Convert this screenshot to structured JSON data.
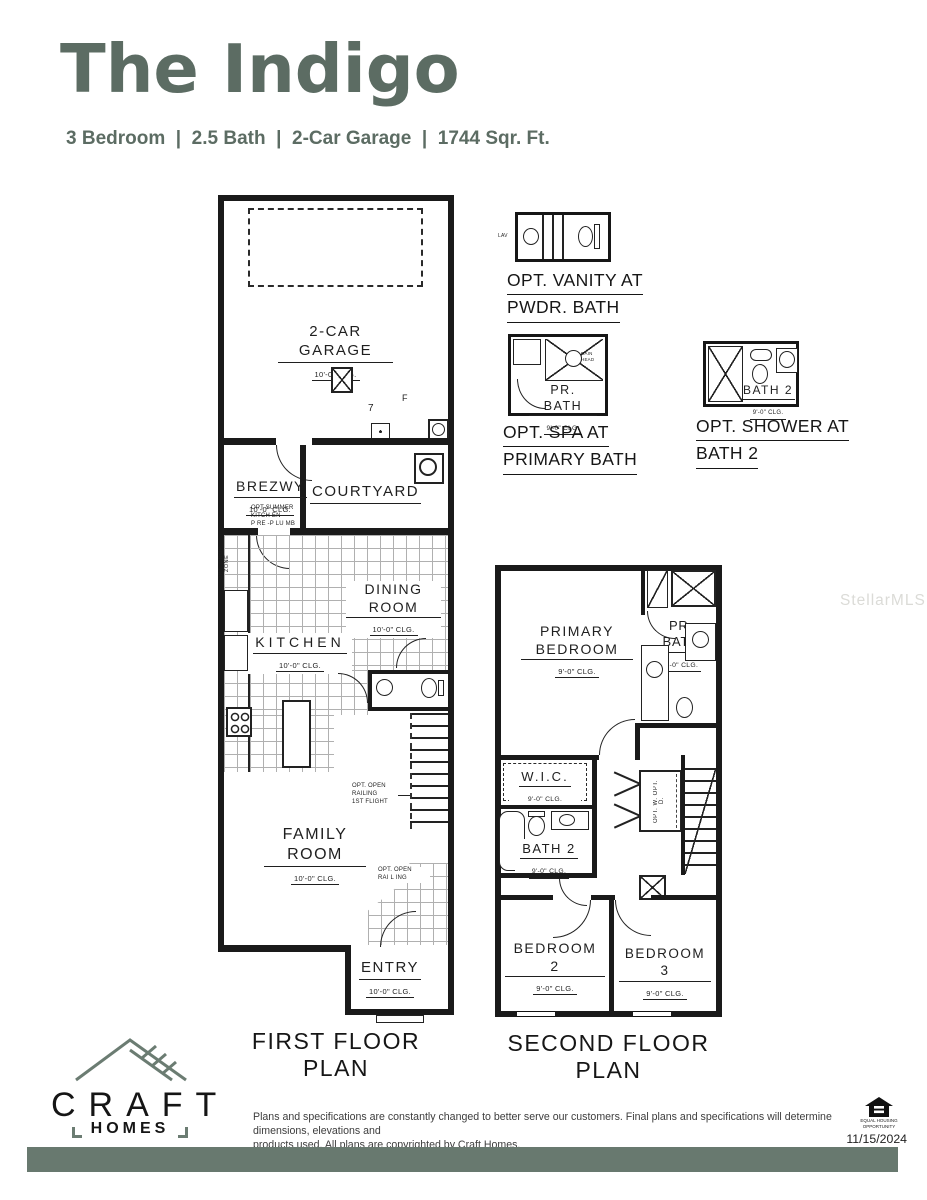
{
  "header": {
    "title": "The Indigo",
    "subtitle": "3 Bedroom  |  2.5 Bath  |  2-Car Garage  |  1744 Sqr. Ft."
  },
  "watermark": "StellarMLS",
  "options": {
    "vanity": {
      "line1": "OPT. VANITY AT",
      "line2": "PWDR. BATH",
      "lav": "LAV"
    },
    "spa": {
      "line1": "OPT. SPA AT",
      "line2": "PRIMARY BATH",
      "room": "PR. BATH",
      "clg": "9'-0\" CLG.",
      "head": "RAIN\nHEAD"
    },
    "shower": {
      "line1": "OPT. SHOWER AT",
      "line2": "BATH 2",
      "room": "BATH 2",
      "clg": "9'-0\" CLG."
    }
  },
  "first_floor": {
    "label": "FIRST FLOOR PLAN",
    "garage": {
      "name": "2-CAR GARAGE",
      "clg": "10'-0\" CLG.",
      "marker7": "7",
      "markerF": "F"
    },
    "brezwy": {
      "name": "BREZWY",
      "clg": "10'-0\" CLG."
    },
    "courtyard": {
      "name": "COURTYARD"
    },
    "dining": {
      "name": "DINING ROOM",
      "clg": "10'-0\" CLG."
    },
    "kitchen": {
      "name": "KITCHEN",
      "clg": "10'-0\" CLG."
    },
    "family": {
      "name": "FAMILY ROOM",
      "clg": "10'-0\" CLG."
    },
    "entry": {
      "name": "ENTRY",
      "clg": "10'-0\" CLG."
    },
    "notes": {
      "drop_zone": "OPT. DROP\nZONE",
      "summer_kitchen": "OPT SUMMER\nKITCH EN\nP RE -P LU MB",
      "open_railing_first": "OPT. OPEN\nRAILING\n1ST FLIGHT",
      "open_railing": "OPT. OPEN\nRAI L ING"
    }
  },
  "second_floor": {
    "label": "SECOND FLOOR PLAN",
    "primary": {
      "name": "PRIMARY BEDROOM",
      "clg": "9'-0\" CLG."
    },
    "pr_bath": {
      "name": "PR. BATH",
      "clg": "9'-0\" CLG."
    },
    "wic": {
      "name": "W.I.C.",
      "clg": "9'-0\" CLG."
    },
    "bath2": {
      "name": "BATH 2",
      "clg": "9'-0\" CLG."
    },
    "bedroom2": {
      "name": "BEDROOM 2",
      "clg": "9'-0\" CLG."
    },
    "bedroom3": {
      "name": "BEDROOM 3",
      "clg": "9'-0\" CLG."
    },
    "notes": {
      "laundry": "OPT. W. OPT. D."
    }
  },
  "footer": {
    "brand": "CRAFT",
    "brand_sub": "HOMES",
    "disclaimer1": "Plans and specifications are constantly changed to better serve our customers. Final plans and specifications will determine dimensions, elevations and",
    "disclaimer2": "products used. All plans are copyrighted by Craft Homes.",
    "equal_housing": "EQUAL HOUSING\nOPPORTUNITY",
    "date": "11/15/2024"
  },
  "colors": {
    "brand_green": "#5c6c63",
    "footer_bar": "#68796f"
  }
}
